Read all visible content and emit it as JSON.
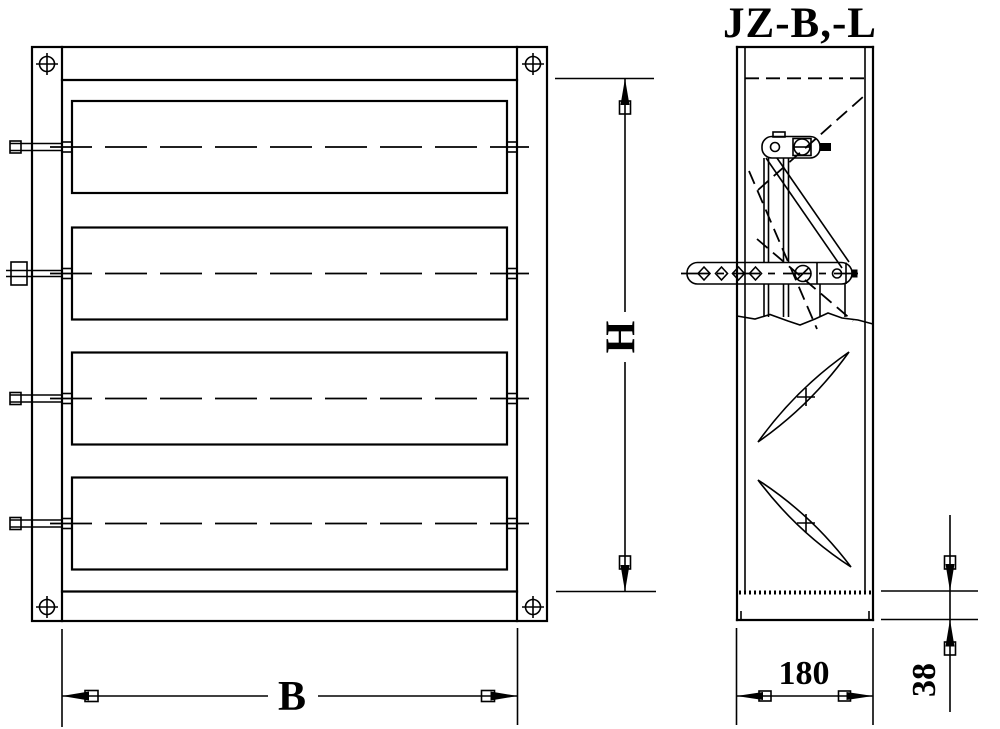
{
  "drawing": {
    "title": "JZ-B,-L",
    "dimensions": {
      "height_label": "H",
      "width_label": "B",
      "depth_label": "180",
      "frame_label": "38"
    }
  }
}
